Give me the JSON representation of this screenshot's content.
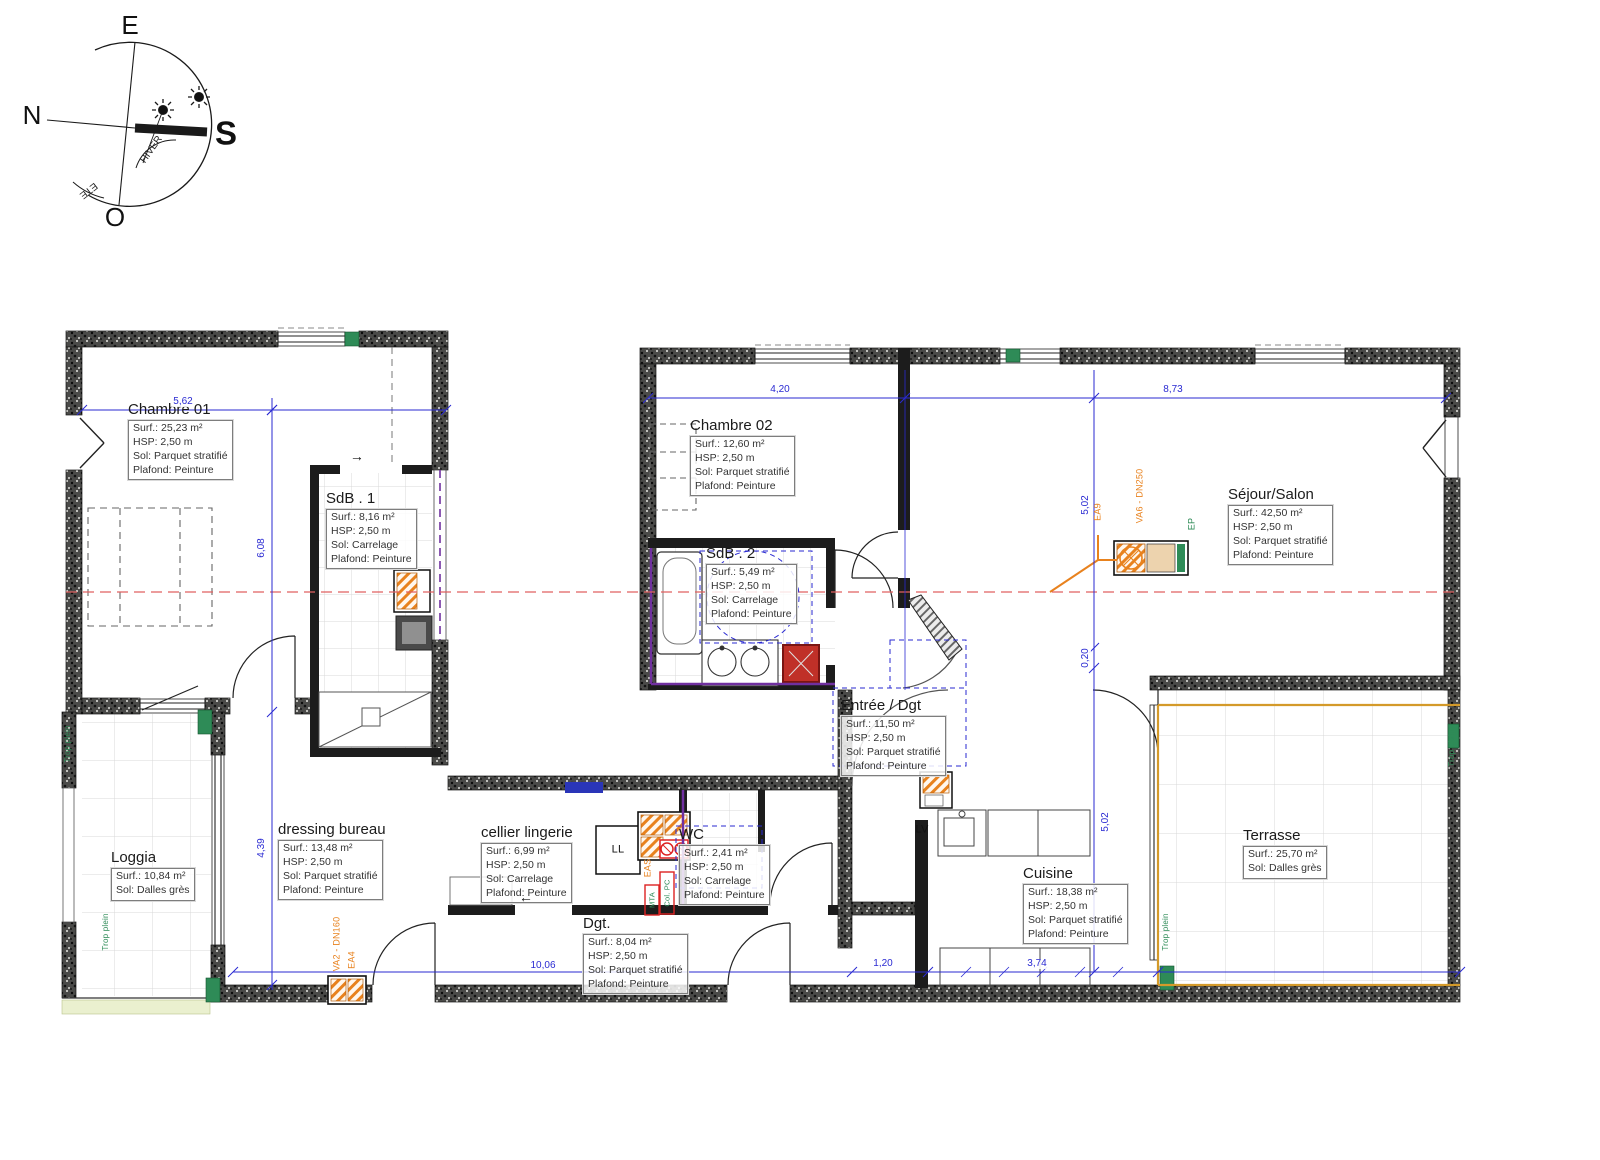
{
  "colors": {
    "dimension_blue": "#2a2ad2",
    "axis_red": "#e06060",
    "plumbing_orange": "#e8821e",
    "vent_green": "#2e8b57",
    "duct_purple": "#7030a0",
    "terrace_border": "#d49a2a",
    "wall_dark": "#4a4a48"
  },
  "compass": {
    "east": "E",
    "north": "N",
    "south": "S",
    "west": "O",
    "winter": "HIVER",
    "summer": "ETE"
  },
  "rooms": [
    {
      "name": "Chambre 01",
      "lines": [
        "Surf.: 25,23 m²",
        "HSP: 2,50 m",
        "Sol: Parquet stratifié",
        "Plafond: Peinture"
      ]
    },
    {
      "name": "SdB . 1",
      "lines": [
        "Surf.: 8,16 m²",
        "HSP: 2,50 m",
        "Sol: Carrelage",
        "Plafond: Peinture"
      ]
    },
    {
      "name": "Chambre 02",
      "lines": [
        "Surf.: 12,60 m²",
        "HSP: 2,50 m",
        "Sol: Parquet stratifié",
        "Plafond: Peinture"
      ]
    },
    {
      "name": "SdB . 2",
      "lines": [
        "Surf.: 5,49 m²",
        "HSP: 2,50 m",
        "Sol: Carrelage",
        "Plafond: Peinture"
      ]
    },
    {
      "name": "Séjour/Salon",
      "lines": [
        "Surf.: 42,50 m²",
        "HSP: 2,50 m",
        "Sol: Parquet stratifié",
        "Plafond: Peinture"
      ]
    },
    {
      "name": "Entrée / Dgt",
      "lines": [
        "Surf.: 11,50 m²",
        "HSP: 2,50 m",
        "Sol: Parquet stratifié",
        "Plafond: Peinture"
      ]
    },
    {
      "name": "dressing bureau",
      "lines": [
        "Surf.: 13,48 m²",
        "HSP: 2,50 m",
        "Sol: Parquet stratifié",
        "Plafond: Peinture"
      ]
    },
    {
      "name": "cellier lingerie",
      "lines": [
        "Surf.: 6,99 m²",
        "HSP: 2,50 m",
        "Sol: Carrelage",
        "Plafond: Peinture"
      ]
    },
    {
      "name": "WC",
      "lines": [
        "Surf.: 2,41 m²",
        "HSP: 2,50 m",
        "Sol: Carrelage",
        "Plafond: Peinture"
      ]
    },
    {
      "name": "Dgt.",
      "lines": [
        "Surf.: 8,04 m²",
        "HSP: 2,50 m",
        "Sol: Parquet stratifié",
        "Plafond: Peinture"
      ]
    },
    {
      "name": "Cuisine",
      "lines": [
        "Surf.: 18,38 m²",
        "HSP: 2,50 m",
        "Sol: Parquet stratifié",
        "Plafond: Peinture"
      ]
    },
    {
      "name": "Loggia",
      "lines": [
        "Surf.: 10,84 m²",
        "Sol: Dalles grès"
      ]
    },
    {
      "name": "Terrasse",
      "lines": [
        "Surf.: 25,70 m²",
        "Sol: Dalles grès"
      ]
    }
  ],
  "dimensions": {
    "top_left": "5,62",
    "top_mid": "4,20",
    "top_right": "8,73",
    "left_upper": "6,08",
    "left_lower": "4,39",
    "right_upper": "5,02",
    "right_mid": "0,20",
    "right_lower": "5,02",
    "bottom_left": "10,06",
    "bottom_mid": "1,20",
    "bottom_right": "3,74"
  },
  "annotations": {
    "washer": "LL",
    "dishwasher": "LV",
    "ea9": "EA9",
    "va6": "VA6 - DN250",
    "ep": "EP",
    "va2": "VA2 - DN160",
    "ea4": "EA4",
    "eas": "EAS",
    "col_pc": "Col. PC",
    "mta": "MTA",
    "overflow": "Trop plein",
    "arrow_right": "→",
    "arrow_left": "←"
  }
}
